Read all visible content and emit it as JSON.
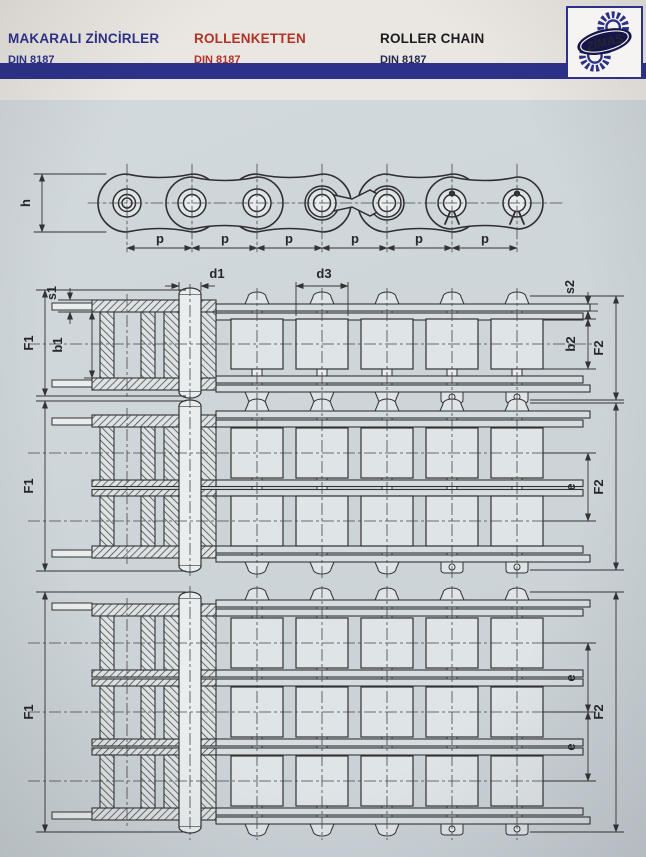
{
  "header": {
    "titles": [
      {
        "label": "MAKARALI ZİNCİRLER",
        "standard": "DIN 8187"
      },
      {
        "label": "ROLLENKETTEN",
        "standard": "DIN 8187"
      },
      {
        "label": "ROLLER CHAIN",
        "standard": "DIN 8187"
      }
    ],
    "logo": {
      "text": "ZİMAŞ"
    }
  },
  "colors": {
    "navy": "#2d3189",
    "red": "#b03427",
    "black": "#1d1d1f",
    "header_background": "#eae7e2",
    "page_background": "#cfd6da",
    "line": "#333333"
  },
  "drawings": {
    "side_view": {
      "height_label": "h",
      "pitch_label": "p",
      "pitch_count": 6
    },
    "simplex": {
      "labels": {
        "s1": "s1",
        "b1": "b1",
        "f1": "F1",
        "d1": "d1",
        "d3": "d3",
        "s2": "s2",
        "b2": "b2",
        "f2": "F2"
      }
    },
    "duplex": {
      "labels": {
        "f1": "F1",
        "e": "e",
        "f2": "F2"
      }
    },
    "triplex": {
      "labels": {
        "f1": "F1",
        "e_top": "e",
        "e_bottom": "e",
        "f2": "F2"
      }
    }
  }
}
